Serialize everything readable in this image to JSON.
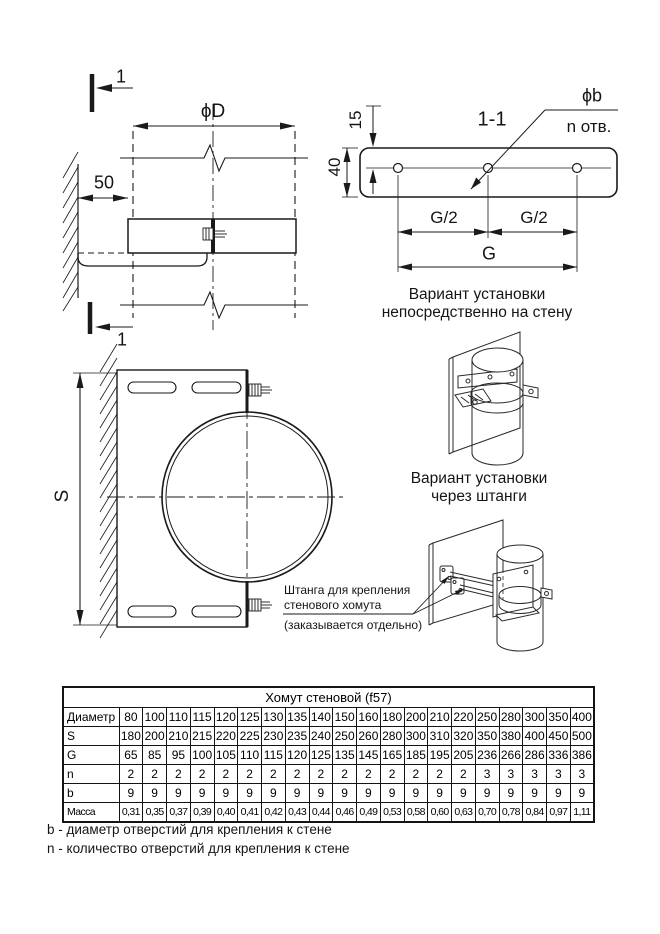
{
  "side_view": {
    "section_mark_top": "1",
    "section_mark_bottom": "1",
    "dim_diameter": "ϕD",
    "dim_offset": "50"
  },
  "section_view": {
    "title": "1-1",
    "hole_diameter_label": "ϕb",
    "hole_count_label": "n отв.",
    "dim_edge": "15",
    "dim_height": "40",
    "dim_half_left": "G/2",
    "dim_half_right": "G/2",
    "dim_total": "G"
  },
  "front_view": {
    "dim_height": "S"
  },
  "captions": {
    "direct_line1": "Вариант установки",
    "direct_line2": "непосредственно на стену",
    "rods_line1": "Вариант установки",
    "rods_line2": "через штанги"
  },
  "annotation": {
    "line1": "Штанга для крепления",
    "line2": "стенового хомута",
    "note": "(заказывается отдельно)"
  },
  "table": {
    "title": "Хомут стеновой (f57)",
    "rows": [
      {
        "header": "Диаметр",
        "values": [
          "80",
          "100",
          "110",
          "115",
          "120",
          "125",
          "130",
          "135",
          "140",
          "150",
          "160",
          "180",
          "200",
          "210",
          "220",
          "250",
          "280",
          "300",
          "350",
          "400"
        ]
      },
      {
        "header": "S",
        "values": [
          "180",
          "200",
          "210",
          "215",
          "220",
          "225",
          "230",
          "235",
          "240",
          "250",
          "260",
          "280",
          "300",
          "310",
          "320",
          "350",
          "380",
          "400",
          "450",
          "500"
        ]
      },
      {
        "header": "G",
        "values": [
          "65",
          "85",
          "95",
          "100",
          "105",
          "110",
          "115",
          "120",
          "125",
          "135",
          "145",
          "165",
          "185",
          "195",
          "205",
          "236",
          "266",
          "286",
          "336",
          "386"
        ]
      },
      {
        "header": "n",
        "values": [
          "2",
          "2",
          "2",
          "2",
          "2",
          "2",
          "2",
          "2",
          "2",
          "2",
          "2",
          "2",
          "2",
          "2",
          "2",
          "3",
          "3",
          "3",
          "3",
          "3"
        ]
      },
      {
        "header": "b",
        "values": [
          "9",
          "9",
          "9",
          "9",
          "9",
          "9",
          "9",
          "9",
          "9",
          "9",
          "9",
          "9",
          "9",
          "9",
          "9",
          "9",
          "9",
          "9",
          "9",
          "9"
        ]
      },
      {
        "header": "Масса",
        "values": [
          "0,31",
          "0,35",
          "0,37",
          "0,39",
          "0,40",
          "0,41",
          "0,42",
          "0,43",
          "0,44",
          "0,46",
          "0,49",
          "0,53",
          "0,58",
          "0,60",
          "0,63",
          "0,70",
          "0,78",
          "0,84",
          "0,97",
          "1,11"
        ]
      }
    ]
  },
  "footnotes": [
    "b - диаметр отверстий для крепления к стене",
    "n - количество отверстий для крепления к стене"
  ],
  "colors": {
    "line": "#1a1a1a",
    "text": "#151515"
  }
}
